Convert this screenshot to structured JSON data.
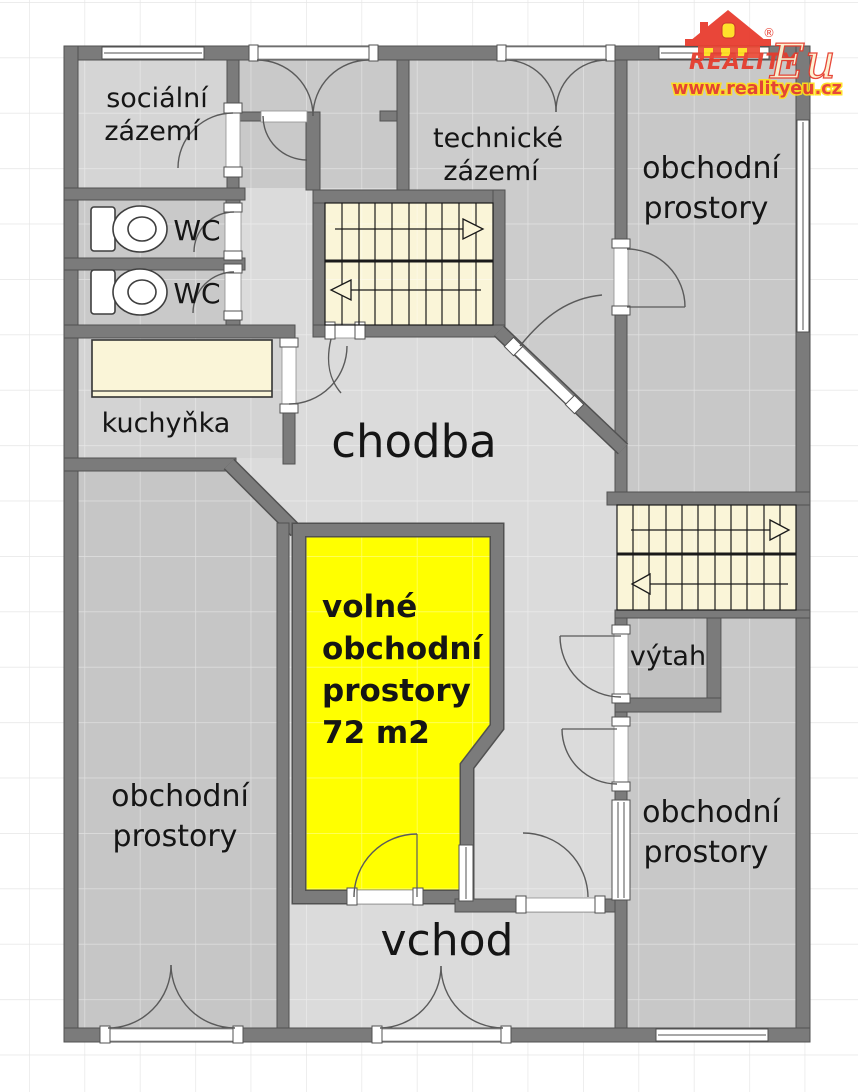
{
  "brand": {
    "name_primary": "REALITY",
    "name_secondary": "Eu",
    "registered_mark": "®",
    "website": "www.realityeu.cz"
  },
  "colors": {
    "highlight_room": "#ffff00",
    "wall": "#7b7b7b",
    "corridor": "#dbdbdb",
    "stairs_fill": "#faf5d8",
    "brand_red": "#e63b2c",
    "brand_yellow": "#ffdf1c"
  },
  "rooms": {
    "socialni_zazemi": {
      "line1": "sociální",
      "line2": "zázemí"
    },
    "wc_top": {
      "label": "WC"
    },
    "wc_bottom": {
      "label": "WC"
    },
    "kuchynka": {
      "label": "kuchyňka"
    },
    "chodba": {
      "label": "chodba"
    },
    "technicke_zazemi": {
      "line1": "technické",
      "line2": "zázemí"
    },
    "obchodni_top_right": {
      "line1": "obchodní",
      "line2": "prostory"
    },
    "obchodni_bottom_left": {
      "line1": "obchodní",
      "line2": "prostory"
    },
    "obchodni_bottom_right": {
      "line1": "obchodní",
      "line2": "prostory"
    },
    "volne_obchodni": {
      "line1": "volné",
      "line2": "obchodní",
      "line3": "prostory",
      "line4": "72 m2"
    },
    "vytah": {
      "label": "výtah"
    },
    "vchod": {
      "label": "vchod"
    }
  }
}
